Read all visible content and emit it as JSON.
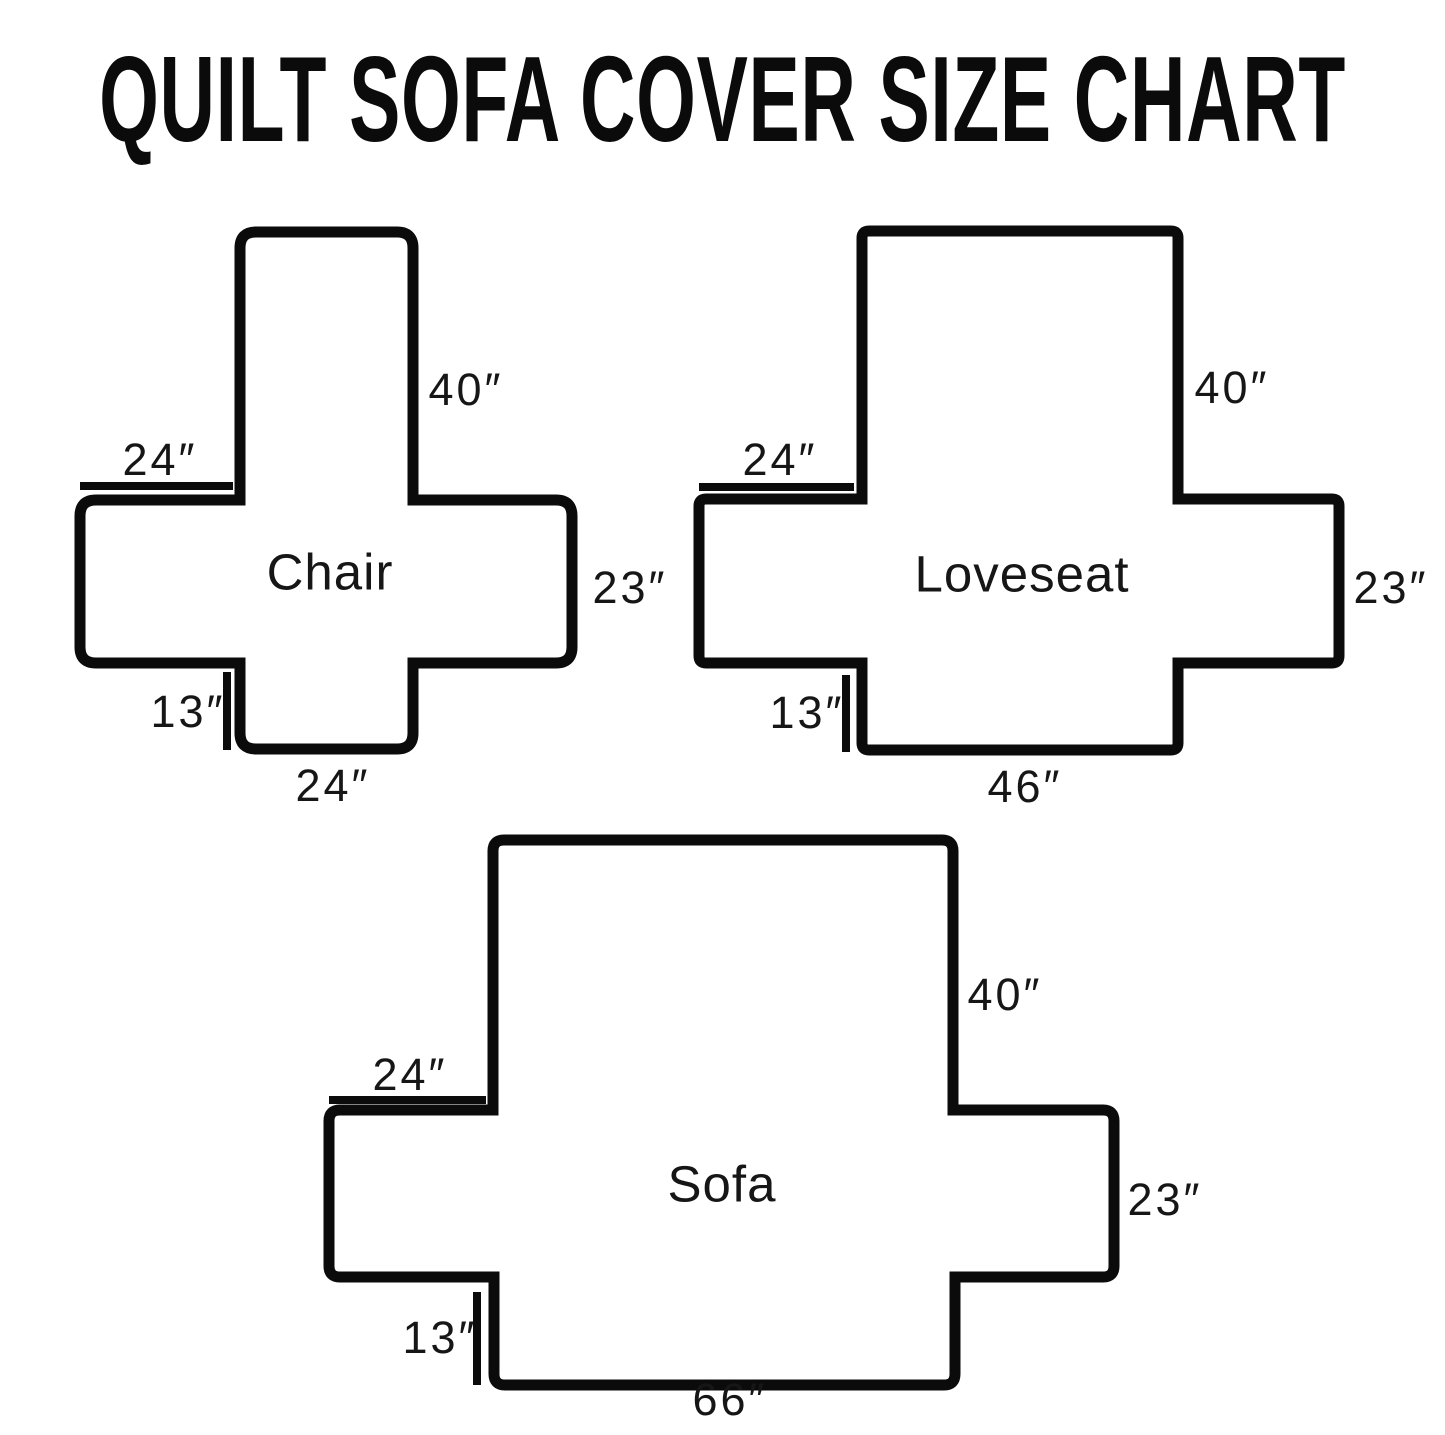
{
  "title": "QUILT SOFA COVER SIZE CHART",
  "diagrams": [
    {
      "name": "Chair",
      "back_height": "40″",
      "arm_top_width": "24″",
      "arm_side_height": "23″",
      "skirt_height": "13″",
      "seat_bottom_width": "24″"
    },
    {
      "name": "Loveseat",
      "back_height": "40″",
      "arm_top_width": "24″",
      "arm_side_height": "23″",
      "skirt_height": "13″",
      "seat_bottom_width": "46″"
    },
    {
      "name": "Sofa",
      "back_height": "40″",
      "arm_top_width": "24″",
      "arm_side_height": "23″",
      "skirt_height": "13″",
      "seat_bottom_width": "66″"
    }
  ],
  "colors": {
    "ink": "#0b0b0b",
    "background": "#ffffff"
  }
}
